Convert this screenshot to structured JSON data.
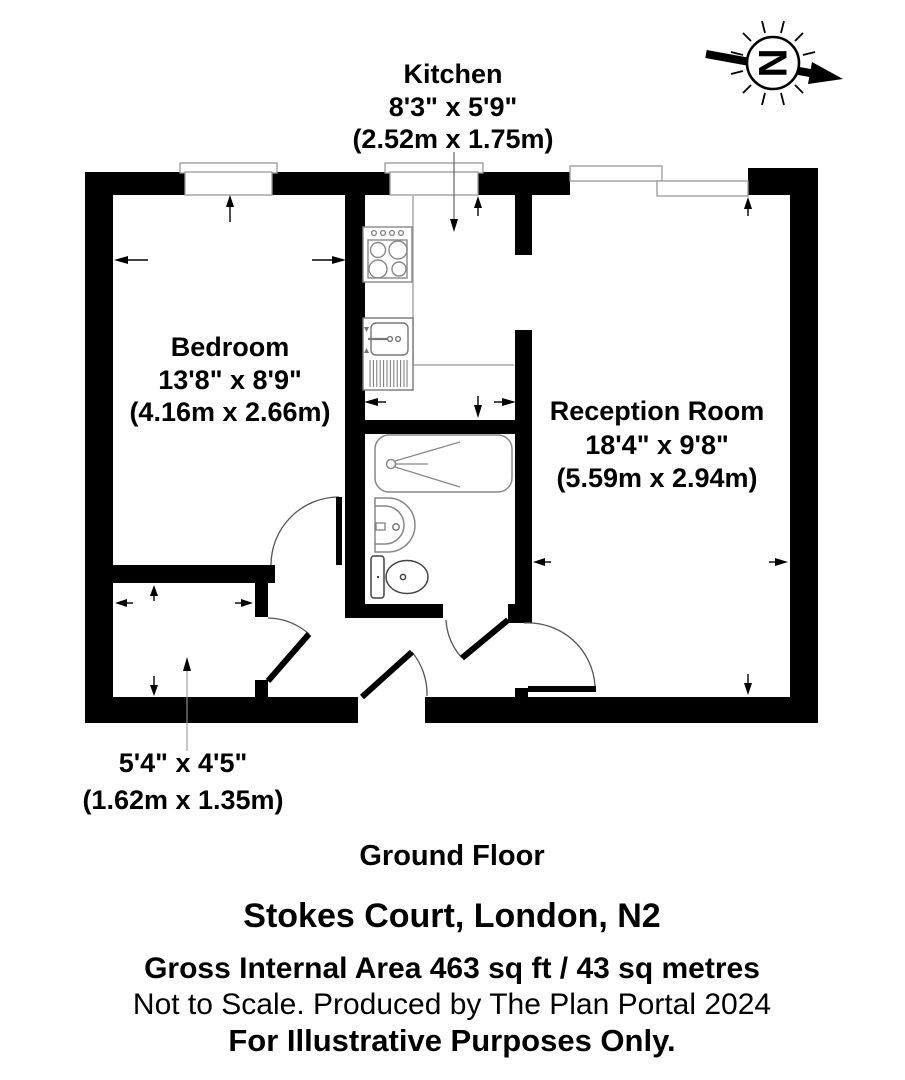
{
  "plan": {
    "floor_label": "Ground Floor",
    "rooms": {
      "kitchen": {
        "name": "Kitchen",
        "dims_ft": "8'3\" x 5'9\"",
        "dims_m": "(2.52m x 1.75m)"
      },
      "bedroom": {
        "name": "Bedroom",
        "dims_ft": "13'8\" x 8'9\"",
        "dims_m": "(4.16m x 2.66m)"
      },
      "reception": {
        "name": "Reception Room",
        "dims_ft": "18'4\" x 9'8\"",
        "dims_m": "(5.59m x 2.94m)"
      },
      "hallway": {
        "dims_ft": "5'4\" x 4'5\"",
        "dims_m": "(1.62m x 1.35m)"
      }
    },
    "compass": {
      "letter": "N"
    }
  },
  "footer": {
    "address": "Stokes Court, London, N2",
    "area": "Gross Internal Area 463 sq ft / 43 sq metres",
    "produced": "Not to Scale. Produced by The Plan Portal 2024",
    "disclaimer": "For Illustrative Purposes Only."
  },
  "colors": {
    "wall": "#000000",
    "fixture_line": "#888888",
    "window_line": "#999999",
    "background": "#ffffff"
  }
}
